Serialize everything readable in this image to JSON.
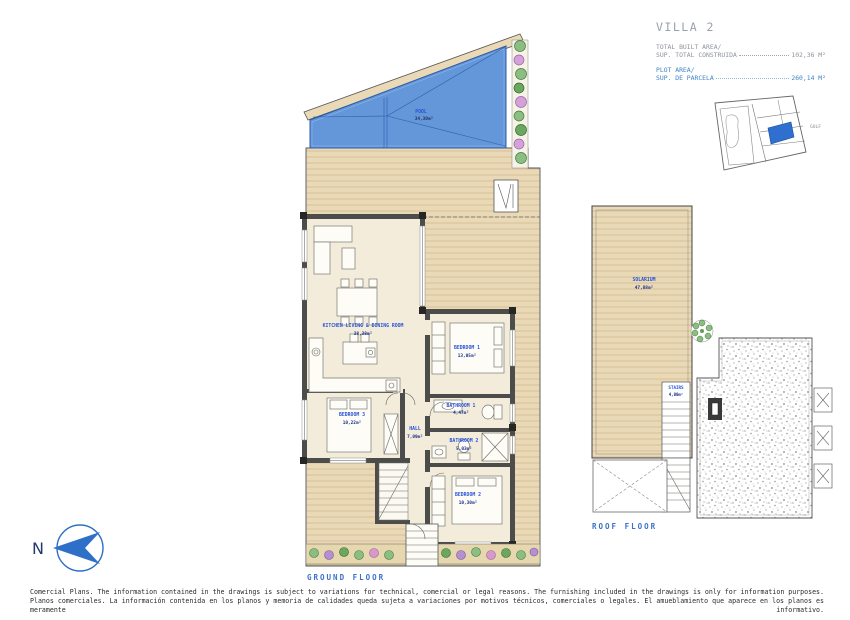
{
  "title_block": {
    "villa": "VILLA 2",
    "built_area": {
      "label_en": "TOTAL BUILT AREA/",
      "label_es": "SUP. TOTAL CONSTRUIDA",
      "value": "102,36 M²"
    },
    "plot_area": {
      "label_en": "PLOT AREA/",
      "label_es": "SUP. DE PARCELA",
      "value": "260,14 M²"
    }
  },
  "site_plan": {
    "golf_label": "GOLF"
  },
  "compass": {
    "north_label": "N"
  },
  "ground_floor": {
    "caption": "GROUND FLOOR",
    "rooms": [
      {
        "name": "POOL",
        "area": "34,30m²"
      },
      {
        "name": "KITCHEN LIVING & DINING ROOM",
        "area": "38,38m²"
      },
      {
        "name": "BEDROOM 1",
        "area": "13,05m²"
      },
      {
        "name": "BATHROOM 1",
        "area": "4,47m²"
      },
      {
        "name": "HALL",
        "area": "7,09m²"
      },
      {
        "name": "BATHROOM 2",
        "area": "5,03m²"
      },
      {
        "name": "BEDROOM 3",
        "area": "10,22m²"
      },
      {
        "name": "BEDROOM 2",
        "area": "10,30m²"
      }
    ]
  },
  "roof_floor": {
    "caption": "ROOF FLOOR",
    "rooms": [
      {
        "name": "SOLARIUM",
        "area": "47,88m²"
      },
      {
        "name": "STAIRS",
        "area": "4,00m²"
      }
    ]
  },
  "footer": {
    "line_en": "Comercial Plans. The information contained in the drawings is subject to variations for technical, comercial or legal reasons. The furnishing included in the drawings is only for information purposes.",
    "line_es": "Planos comerciales. La información contenida en los planos y memoria de calidades queda sujeta a variaciones por motivos técnicos, comerciales o legales. El amueblamiento que aparece en los planos es meramente informativo."
  },
  "colors": {
    "accent_blue": "#3a72c8",
    "pool_blue": "#6496da",
    "deck_tan": "#ead9b6",
    "room_label_blue": "#2853d6",
    "wall_gray": "#4c4c4a"
  }
}
